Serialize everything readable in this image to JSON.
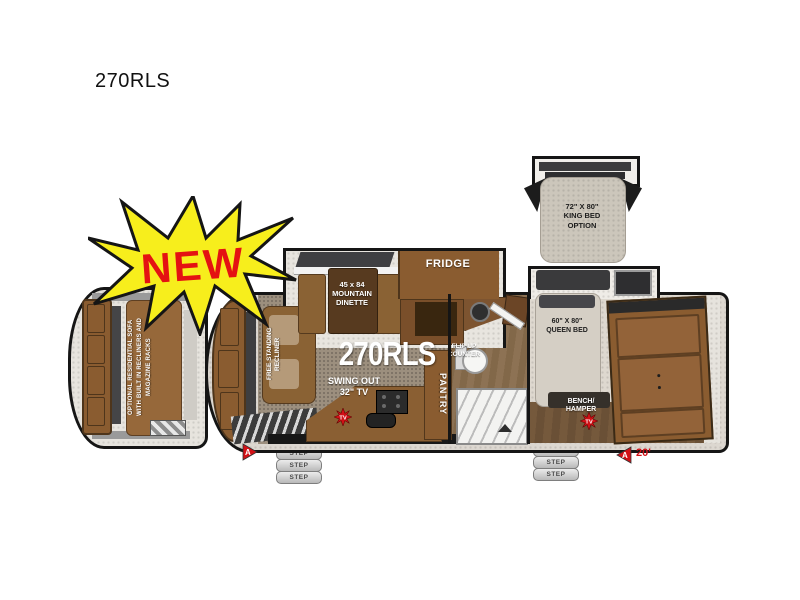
{
  "title": "270RLS",
  "badge": {
    "text": "NEW",
    "fill": "#f7ee1c",
    "text_color": "#e41212"
  },
  "labels": {
    "model_floor": "270RLS",
    "optional_sofa": "OPTIONAL RESIDENTIAL SOFA\nWITH BUILT IN RECLINERS AND\nMAGAZINE RACKS",
    "recliner": "FREE STANDING\nRECLINER",
    "dinette": "45 x 84\nMOUNTAIN\nDINETTE",
    "fridge": "FRIDGE",
    "swing_tv": "SWING OUT\n32\" TV",
    "flip_counter": "FLIP UP\nCOUNTER",
    "pantry": "PANTRY",
    "queen_bed": "60\" X 80\"\nQUEEN BED",
    "king_bed": "72\" X 80\"\nKING BED\nOPTION",
    "bench_hamper": "BENCH/\nHAMPER"
  },
  "markers": {
    "step": "STEP",
    "tv": "TV",
    "a": "A",
    "length": "20'"
  },
  "colors": {
    "wall": "#151515",
    "cabinet_brown": "#8a5c30",
    "table_brown": "#573a1f",
    "floor_brown": "#9c8f7e",
    "carpet": "#e7e4de",
    "mattress": "#d2ccc2",
    "accent_red": "#d21016",
    "accent_yellow": "#f7ee1c"
  }
}
